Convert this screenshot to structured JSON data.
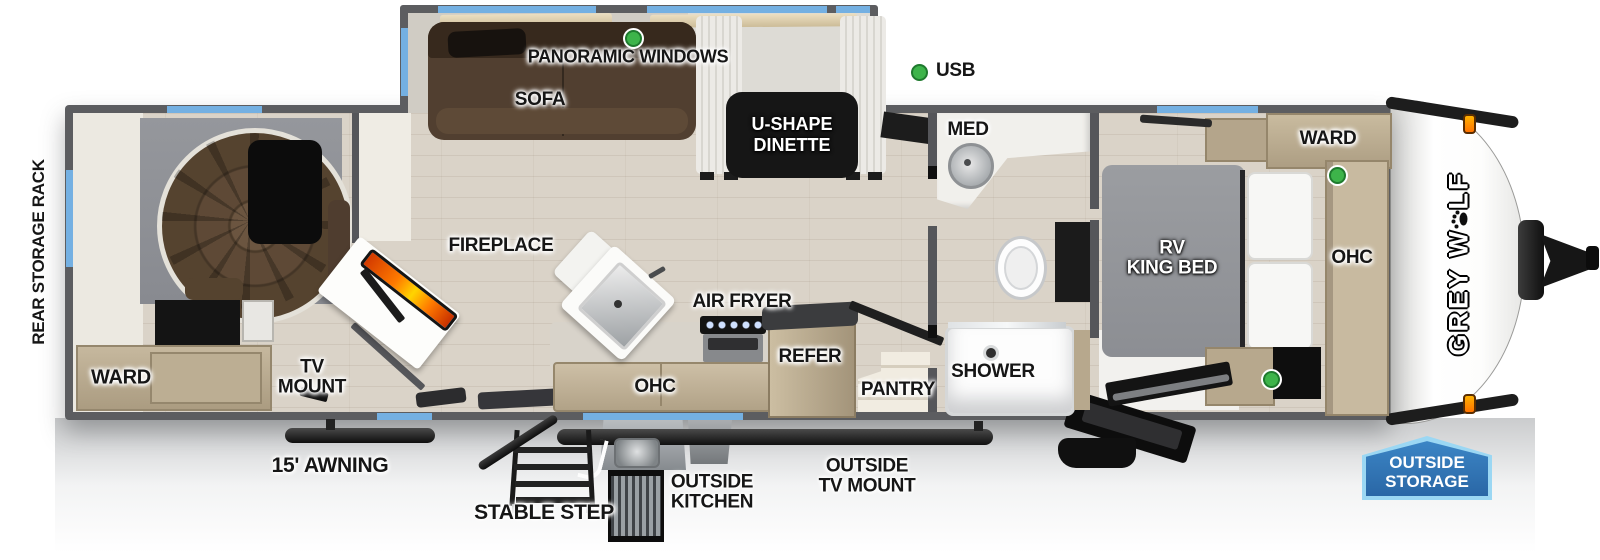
{
  "title": "Grey Wolf travel trailer floor plan",
  "colors": {
    "wall_gray": "#5c5d60",
    "window_blue": "#74b0e2",
    "usb_green": "#3db44a",
    "badge_blue": "#2f74b6",
    "badge_border": "#9bd7f3",
    "flame_orange": "#ff6a00",
    "cabinet_tan": "#bdae93",
    "floor_wood": "#dad3c8"
  },
  "legend": {
    "usb": "USB"
  },
  "brand": [
    "GREY",
    "W",
    "LF"
  ],
  "labels": {
    "rear_storage_rack": "REAR STORAGE RACK",
    "rear_ward": "WARD",
    "tv_mount": [
      "TV",
      "MOUNT"
    ],
    "awning": "15' AWNING",
    "panoramic_windows": "PANORAMIC WINDOWS",
    "sofa": "SOFA",
    "dinette": [
      "U-SHAPE",
      "DINETTE"
    ],
    "fireplace": "FIREPLACE",
    "air_fryer": "AIR FRYER",
    "kitchen_ohc": "OHC",
    "refer": "REFER",
    "pantry": "PANTRY",
    "med": "MED",
    "shower": "SHOWER",
    "king_bed": [
      "RV",
      "KING BED"
    ],
    "front_ward": "WARD",
    "front_ohc": "OHC",
    "stable_step": "STABLE STEP",
    "outside_kitchen": [
      "OUTSIDE",
      "KITCHEN"
    ],
    "outside_tv_mount": [
      "OUTSIDE",
      "TV MOUNT"
    ],
    "outside_storage": [
      "OUTSIDE",
      "STORAGE"
    ]
  }
}
